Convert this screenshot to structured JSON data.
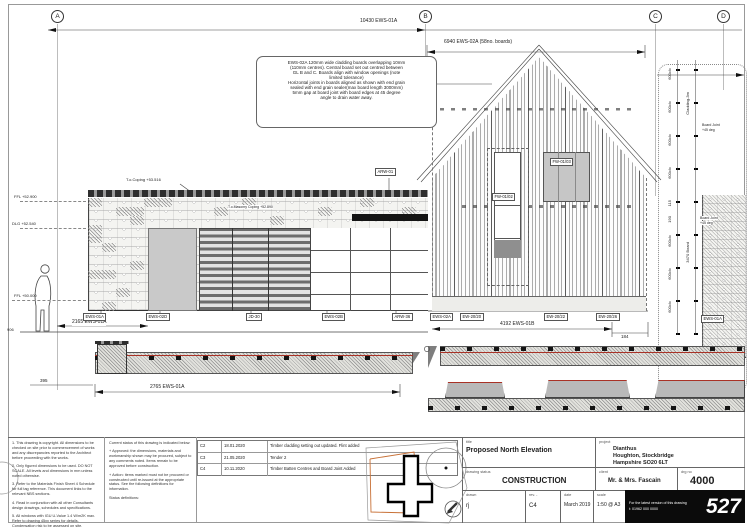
{
  "colors": {
    "cladding_red": "#a93226",
    "site_boundary": "#c87137"
  },
  "sheet": {
    "grid_labels": [
      "A",
      "B",
      "C",
      "D"
    ]
  },
  "dims": {
    "top_span": "10430 EWS-01A",
    "gable_span": "6940 EWS-02A (58no. boards)",
    "left_wall": "2165 EWS-01A",
    "gable_base": "4192 EWS-01B",
    "gable_gap": "184",
    "plan_left": "2765 EWS-01A",
    "plan_offset": "395",
    "plan_height": "906",
    "batten_cc": "600c/c",
    "d115": "115",
    "d190": "190",
    "d120": "120",
    "cladding_len": "Cladding-3m",
    "board_len": "3470 Board",
    "joint_note_1": "Board Joint",
    "joint_note_2": "+45 deg"
  },
  "levels": {
    "coping": "T.o.Coping +53.516",
    "masonry_coping": "T.o.Masonry Coping +52.890",
    "ffl_upper": "FFL +52.900",
    "dlg": "DLG +52.540",
    "ffl_lower": "FFL +50.000"
  },
  "note_box": {
    "lines": [
      "EWS-02A 120mm wide cladding boards overlapping 10mm",
      "(110mm centres). Central board set out centred between",
      "GL B and C. Boards align with window openings (note",
      "limited tolerance)",
      "Horizontal joints in boards aligned as shown with end grain",
      "sealed with end grain sealer(max board length 3000mm)",
      "5mm gap at board joint with board edges at 45 degree",
      "angle to drain water away."
    ]
  },
  "tags": {
    "arw01": "ARW-01",
    "row": [
      "EWS-01A",
      "EWS-02D",
      "JD-30",
      "EWS-02B",
      "ARW-36",
      "EWS-02A",
      "EW-20/20",
      "EW-20/22",
      "EW-20/26",
      "EWS-01A"
    ],
    "right_wall": "EWS-01A",
    "fw_left": "FW-01/02",
    "fw_right": "FW-01/03"
  },
  "rev": {
    "rows": [
      {
        "code": "C2",
        "date": "18.01.2020",
        "desc": "Timber cladding setting out updated. Flint added"
      },
      {
        "code": "C3",
        "date": "21.05.2020",
        "desc": "Tender 2"
      },
      {
        "code": "C4",
        "date": "10.11.2020",
        "desc": "Timber Batten Centres and Board Joint Added"
      }
    ]
  },
  "notes": {
    "col1": [
      "1. This drawing is copyright. All dimensions to be checked on site prior to commencement of works and any discrepancies reported to the Architect before proceeding with the works.",
      "2. Only figured dimensions to be used. DO NOT SCALE. All levels and dimensions in mm unless noted otherwise.",
      "3. Refer to the Materials Finish Sheet 4 Schedule for full tag reference. This document links to the relevant NBS sections.",
      "4. Read in conjunction with all other Consultants design drawings, schedules and specifications.",
      "5. All windows with IGU U-Value 1.4 W/m2K max. Refer to drawing 45xx series for details. Condensation risk to be assessed on site."
    ],
    "col2": [
      "Current status of this drawing is indicated below:",
      "+ Approved: the dimensions, materials and workmanship shown may be procured, subject to any comments noted. Items remain to be approved before construction.",
      "+ Action: items marked must not be procured or constructed until re-issued at the appropriate status. See the following definitions for information.",
      "Status definitions:"
    ]
  },
  "tb": {
    "title_label": "title",
    "title": "Proposed North Elevation",
    "project_label": "project",
    "project_1": "Dianthus",
    "project_2": "Houghton, Stockbridge",
    "project_3": "Hampshire SO20 6LT",
    "status_label": "drawing status",
    "status": "CONSTRUCTION",
    "client_label": "client",
    "client": "Mr. & Mrs. Fascain",
    "drg_no_label": "drg no",
    "drg_no": "4000",
    "drawn_label": "drawn",
    "drawn": "rj",
    "rev_label": "rev. -",
    "rev": "C4",
    "date_label": "date",
    "date": "March 2019",
    "scale_label": "scale",
    "scale": "1:50 @ A3",
    "contact_line1": "For the latest version of this drawing",
    "contact_line2": "t: 01962 000 0000",
    "sheet_no": "527"
  }
}
